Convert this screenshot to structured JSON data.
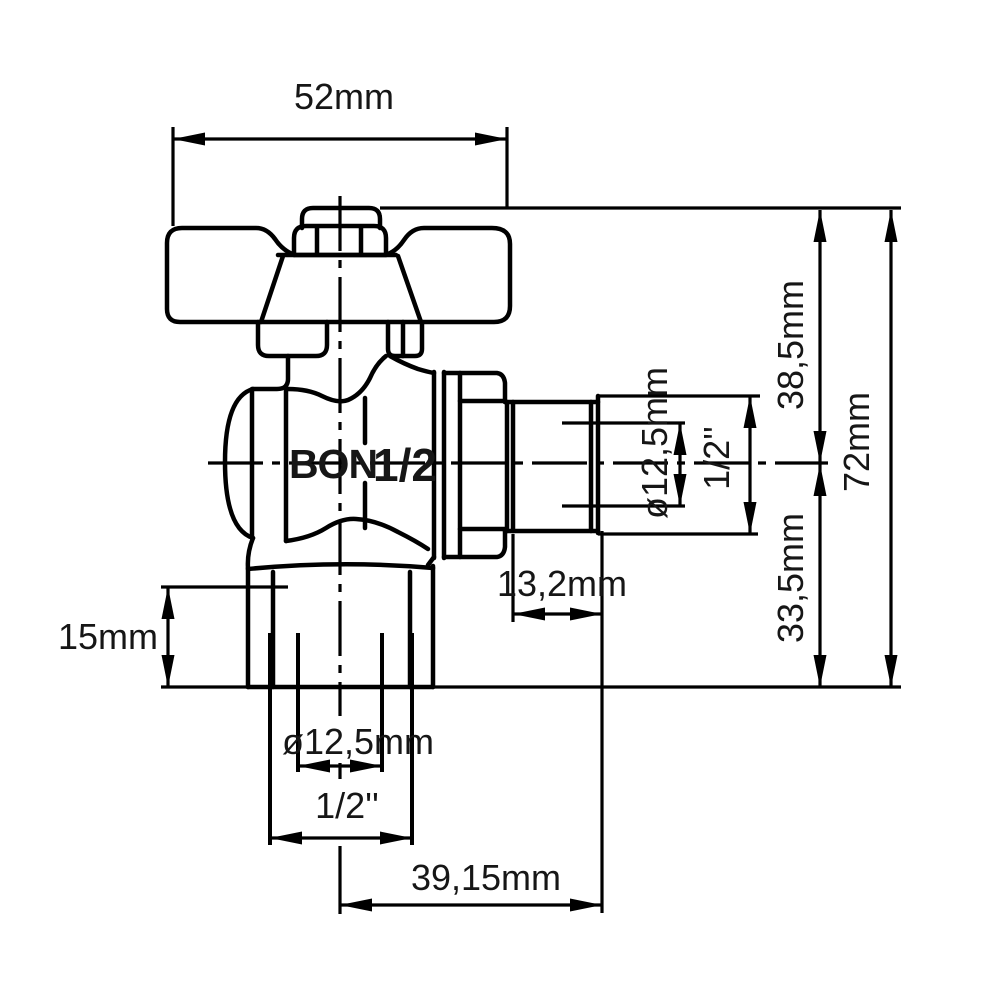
{
  "labels": {
    "brand": "BON",
    "brand_size": "1/2"
  },
  "dimensions": {
    "handle_width": "52mm",
    "upper_height": "38,5mm",
    "overall_height": "72mm",
    "lower_height": "33,5mm",
    "side_port_bore": "ø12,5mm",
    "side_port_thread": "1/2''",
    "side_thread_length": "13,2mm",
    "bottom_nut_height": "15mm",
    "bottom_port_bore": "ø12,5mm",
    "bottom_port_thread": "1/2''",
    "axis_to_port_end": "39,15mm"
  }
}
